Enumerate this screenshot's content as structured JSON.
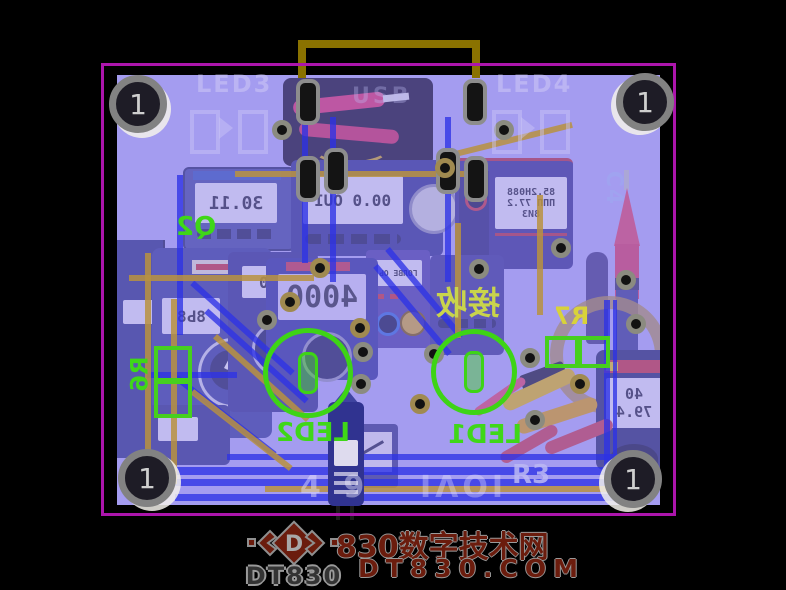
{
  "watermark": {
    "logo_letter": "D",
    "brand": "DT830",
    "site_name": "830数字技术网",
    "domain": "DT830.COM"
  },
  "pcb": {
    "fiducial_label": "1",
    "silkscreen": {
      "led1": "LED1",
      "led2": "LED2",
      "led3": "LED3",
      "led4": "LED4",
      "q2": "Q2",
      "r6": "R6",
      "r7": "R7",
      "r3": "R3",
      "c4": "C4",
      "cn_mirrored": "接收",
      "faint_left": "4 9",
      "faint_right": "IΛOI",
      "usb": "USB"
    },
    "colors": {
      "outline": "#ac15ac",
      "substrate": "#aea7ef",
      "silk_green": "#3fd718",
      "silk_yellow": "#d8d23a",
      "handle_gold": "#8a7200"
    }
  },
  "photo": {
    "lcd": {
      "top_left": "30.11",
      "top_center": "00.0 OUI",
      "top_right_main": "85.2H088",
      "top_right_sub": "8ИЗ",
      "top_right_bars": "ΠΠΠ 77.2",
      "center": "ГОЛВЕ ОЬ",
      "big": "4000",
      "cluster": "8Ь8",
      "mid_left": ".00",
      "bottom_right_top": "40",
      "bottom_right_bottom": "79.4"
    }
  }
}
